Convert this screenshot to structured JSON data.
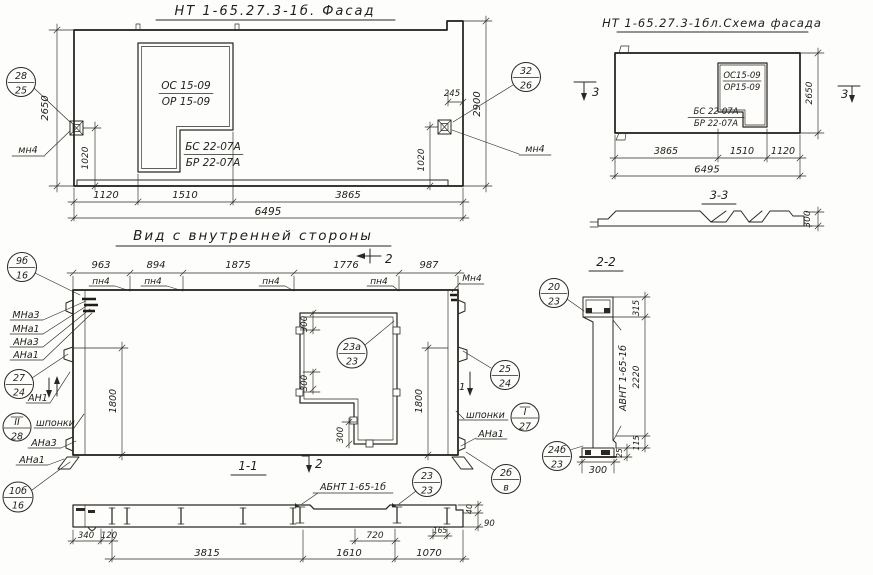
{
  "facade": {
    "title": "НТ 1-65.27.3-1б. Фасад",
    "window_mark_1": "ОС 15-09",
    "window_mark_2": "ОР 15-09",
    "sill_mark_1": "БС 22-07А",
    "sill_mark_2": "БР 22-07А",
    "callout_left_num": "28",
    "callout_left_den": "25",
    "callout_right_num": "32",
    "callout_right_den": "26",
    "anchor_left": "мн4",
    "anchor_right": "мн4",
    "dim_height": "2650",
    "dim_anchor_left": "1020",
    "dim_anchor_right": "1020",
    "dim_offset": "245",
    "dim_height_right": "2900",
    "dim_b1": "1120",
    "dim_b2": "1510",
    "dim_b3": "3865",
    "dim_total": "6495"
  },
  "schema": {
    "title": "НТ 1-65.27.3-1бл.Схема фасада",
    "window_mark_1": "ОС15-09",
    "window_mark_2": "ОР15-09",
    "sill_mark_1": "БС 22-07А",
    "sill_mark_2": "БР 22-07А",
    "section_mark": "3",
    "dim_height": "2650",
    "dim_b1": "3865",
    "dim_b2": "1510",
    "dim_b3": "1120",
    "dim_total": "6495"
  },
  "section33": {
    "title": "3-3",
    "dim_thickness": "300"
  },
  "interior": {
    "title": "Вид с внутренней стороны",
    "dim_t1": "963",
    "dim_t2": "894",
    "dim_t3": "1875",
    "dim_t4": "1776",
    "dim_t5": "987",
    "pn4": "пн4",
    "mn4": "Мн4",
    "sec2": "2",
    "sec1": "1",
    "dim_1800_left": "1800",
    "dim_1800_right": "1800",
    "dim_300_top": "300",
    "dim_300_mid": "300",
    "dim_300_bot": "300",
    "c_9b16_num": "9б",
    "c_9b16_den": "16",
    "lbl_mna3": "МНа3",
    "lbl_mna1": "МНа1",
    "lbl_ana3": "АНа3",
    "lbl_ana1": "АНа1",
    "c_2724_num": "27",
    "c_2724_den": "24",
    "lbl_an1": "АН1",
    "c_ii28_num": "II",
    "c_ii28_den": "28",
    "lbl_shponki_left": "шпонки",
    "lbl_ana3_bottom": "АНа3",
    "lbl_ana1_bottom": "АНа1",
    "c_2524_num": "25",
    "c_2524_den": "24",
    "lbl_shponki_right": "шпонки",
    "c_i27_num": "I",
    "c_i27_den": "27",
    "lbl_ana1_right": "АНа1",
    "c_23a23_num": "23а",
    "c_23a23_den": "23",
    "c_2b_num": "2б",
    "c_2b_den": "в"
  },
  "section22": {
    "title": "2-2",
    "label": "АВНТ 1-65-1б",
    "c_2023_num": "20",
    "c_2023_den": "23",
    "c_24b23_num": "24б",
    "c_24b23_den": "23",
    "dim_315": "315",
    "dim_2220": "2220",
    "dim_115": "115",
    "dim_25": "25",
    "dim_300": "300"
  },
  "section11": {
    "title": "1-1",
    "label": "АБНТ 1-65-1б",
    "c_10b16_num": "10б",
    "c_10b16_den": "16",
    "c_2323_num": "23",
    "c_2323_den": "23",
    "sec2": "2",
    "dim_340": "340",
    "dim_120": "120",
    "dim_720": "720",
    "dim_165": "165",
    "dim_40": "40",
    "dim_90": "90",
    "dim_3815": "3815",
    "dim_1610": "1610",
    "dim_1070": "1070"
  }
}
